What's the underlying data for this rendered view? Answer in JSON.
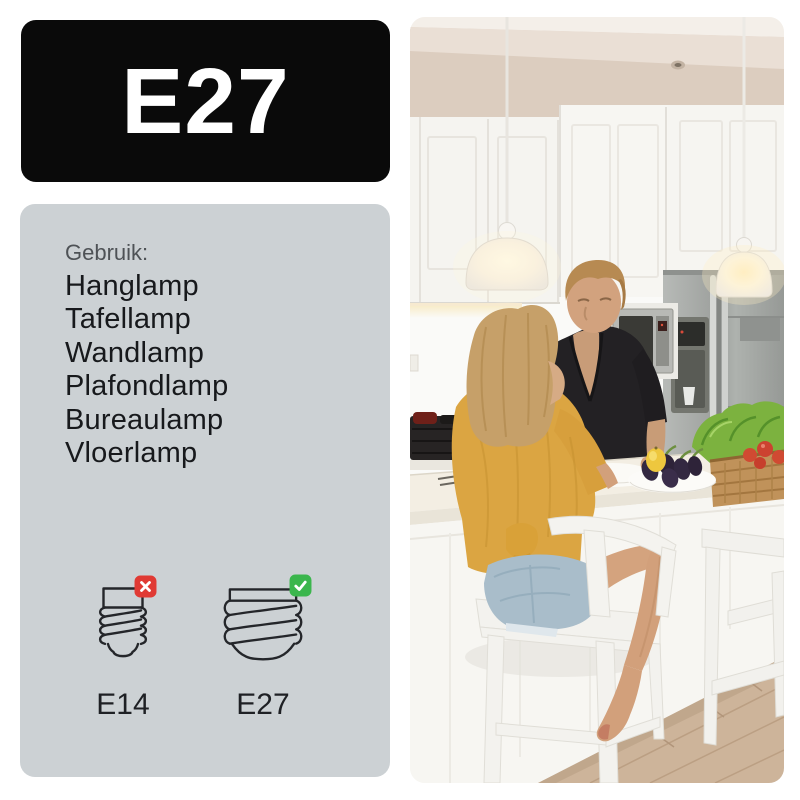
{
  "banner": {
    "label": "E27",
    "background": "#0a0a0a",
    "text_color": "#ffffff"
  },
  "usage": {
    "panel_background": "#ccd1d4",
    "heading": "Gebruik:",
    "items": [
      "Hanglamp",
      "Tafellamp",
      "Wandlamp",
      "Plafondlamp",
      "Bureaulamp",
      "Vloerlamp"
    ]
  },
  "sockets": {
    "outline_color": "#24262a",
    "options": [
      {
        "label": "E14",
        "compatible": false,
        "icon": "e14-socket-icon",
        "badge_icon": "x-icon",
        "badge_color": "#e03a34"
      },
      {
        "label": "E27",
        "compatible": true,
        "icon": "e27-socket-icon",
        "badge_icon": "check-icon",
        "badge_color": "#3bb64d"
      }
    ]
  },
  "photo": {
    "description": "Man in a black shirt and woman in a yellow sweater talking in a bright white kitchen; two glowing pendant lamps hang over the island with vegetables on the counter",
    "colors": {
      "ceiling": "#dccdbf",
      "wall": "#fafaf8",
      "cabinets": "#f5f4f0",
      "counter": "#f3eee3",
      "island": "#f7f6f2",
      "fridge": "#a9ada9",
      "lamp_glow": "#fff3d2",
      "sweater": "#dba542",
      "denim": "#a9bdca",
      "skin": "#d2a07b",
      "man_shirt": "#232124",
      "woman_hair": "#c6a069",
      "man_hair": "#b78a52",
      "floor": "#cdb49a",
      "lettuce": "#7cb23f",
      "tomato": "#d04a32",
      "eggplant": "#332841",
      "lemon": "#eec73e",
      "basket": "#c0925a",
      "stool": "#f3f2ee"
    }
  }
}
